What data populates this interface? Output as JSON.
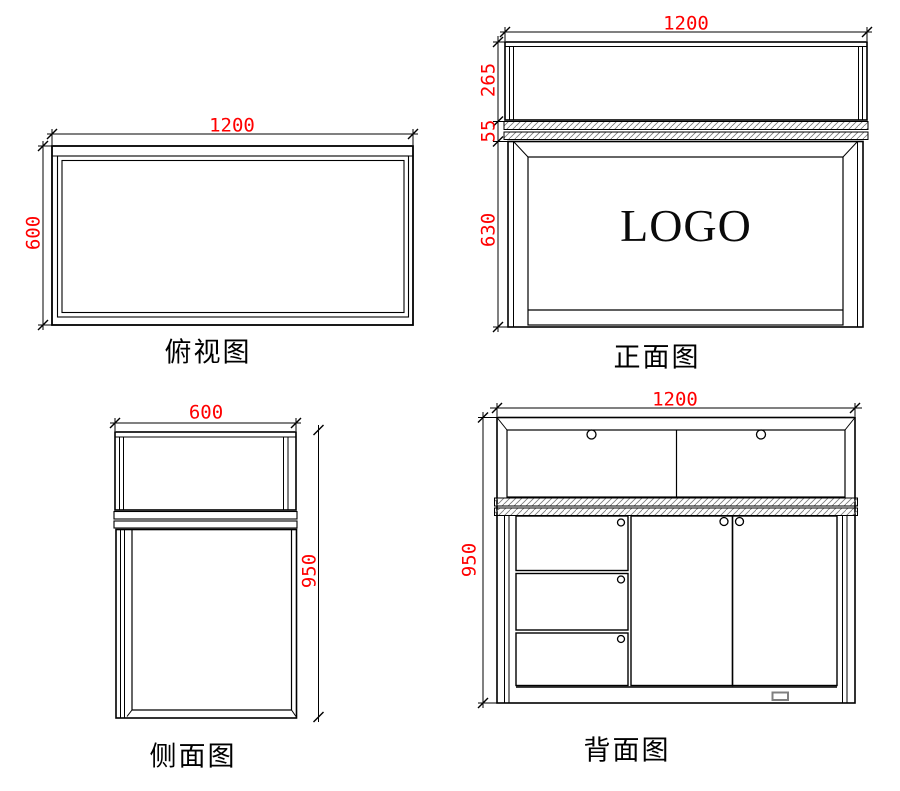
{
  "drawing": {
    "background_color": "#ffffff",
    "line_color": "#000000",
    "dimension_color": "#ff0000",
    "views": {
      "top_view": {
        "title": "俯视图",
        "width_dim": "1200",
        "depth_dim": "600"
      },
      "front_view": {
        "title": "正面图",
        "width_dim": "1200",
        "display_height_dim": "265",
        "counter_thickness_dim": "55",
        "cabinet_height_dim": "630",
        "logo_text": "LOGO"
      },
      "side_view": {
        "title": "侧面图",
        "depth_dim": "600",
        "height_dim": "950"
      },
      "back_view": {
        "title": "背面图",
        "width_dim": "1200",
        "height_dim": "950"
      }
    }
  }
}
